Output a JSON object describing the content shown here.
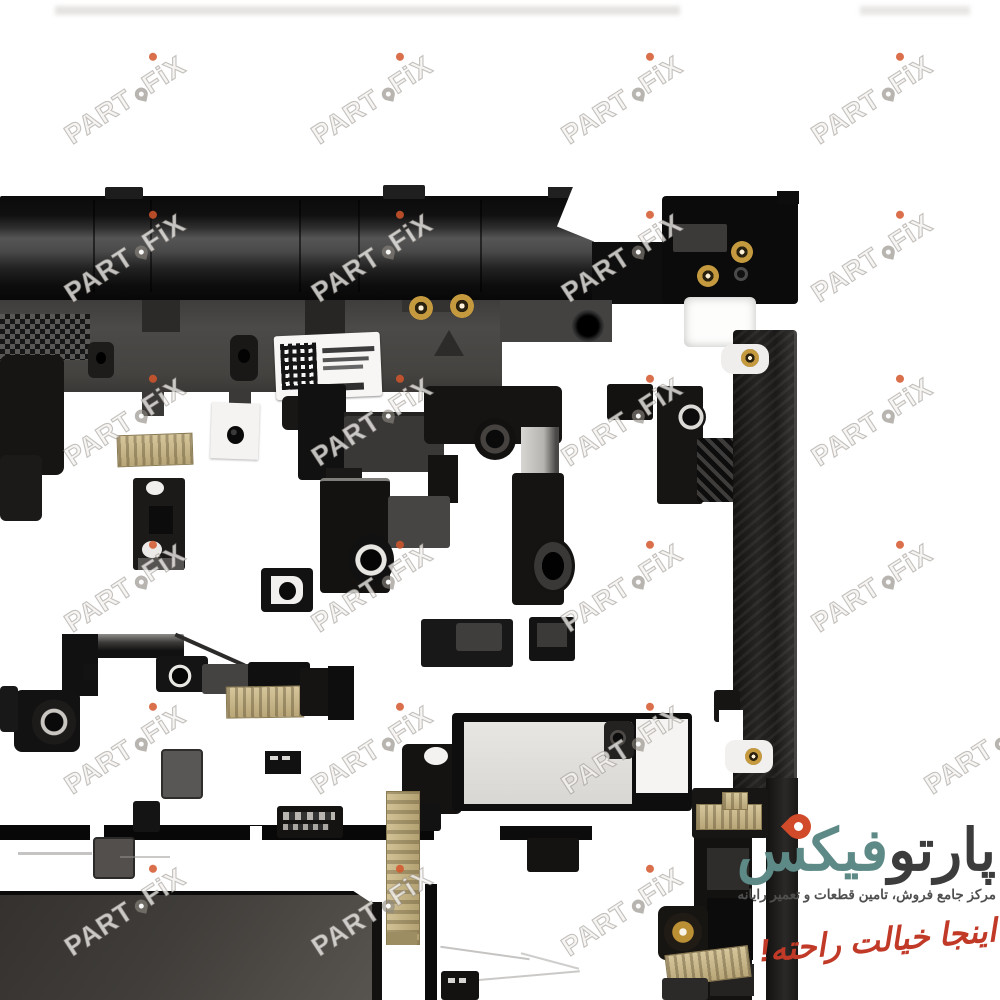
{
  "photo": {
    "subject": "Black laptop palmrest top-case assembly photographed from the inner side on a white background",
    "features": [
      "top hinge rail",
      "keyboard deck with speaker mesh grid",
      "white service barcode label",
      "gold screw standoffs",
      "scattered black mounting brackets and bosses",
      "beige ribbon-cable stiffeners",
      "right side rail",
      "touchpad module at bottom left",
      "warning triangle emboss",
      "metal latch clips with gold pins"
    ],
    "colors": {
      "background": "#ffffff",
      "part_black": "#0c0c0c",
      "deck_gray": "#4a4846",
      "tan": "#c4b286",
      "gold": "#c59a3f",
      "touchpad": "#443f3c"
    }
  },
  "watermark": {
    "part1": "PART",
    "part2": "FiX",
    "dot_color": "#d4562c"
  },
  "logo": {
    "brand_dark": "پارتو",
    "brand_teal": "فیکس",
    "tagline": "مرکز جامع فروش، تامین قطعات و تعمیر رایانه",
    "slogan": "اینجا خیالت راحته!",
    "colors": {
      "dark": "#3c3c3c",
      "teal": "#5d8a86",
      "pin": "#d14a2a",
      "slogan_red": "#c13a28",
      "tagline_gray": "#4f4f4f"
    }
  }
}
